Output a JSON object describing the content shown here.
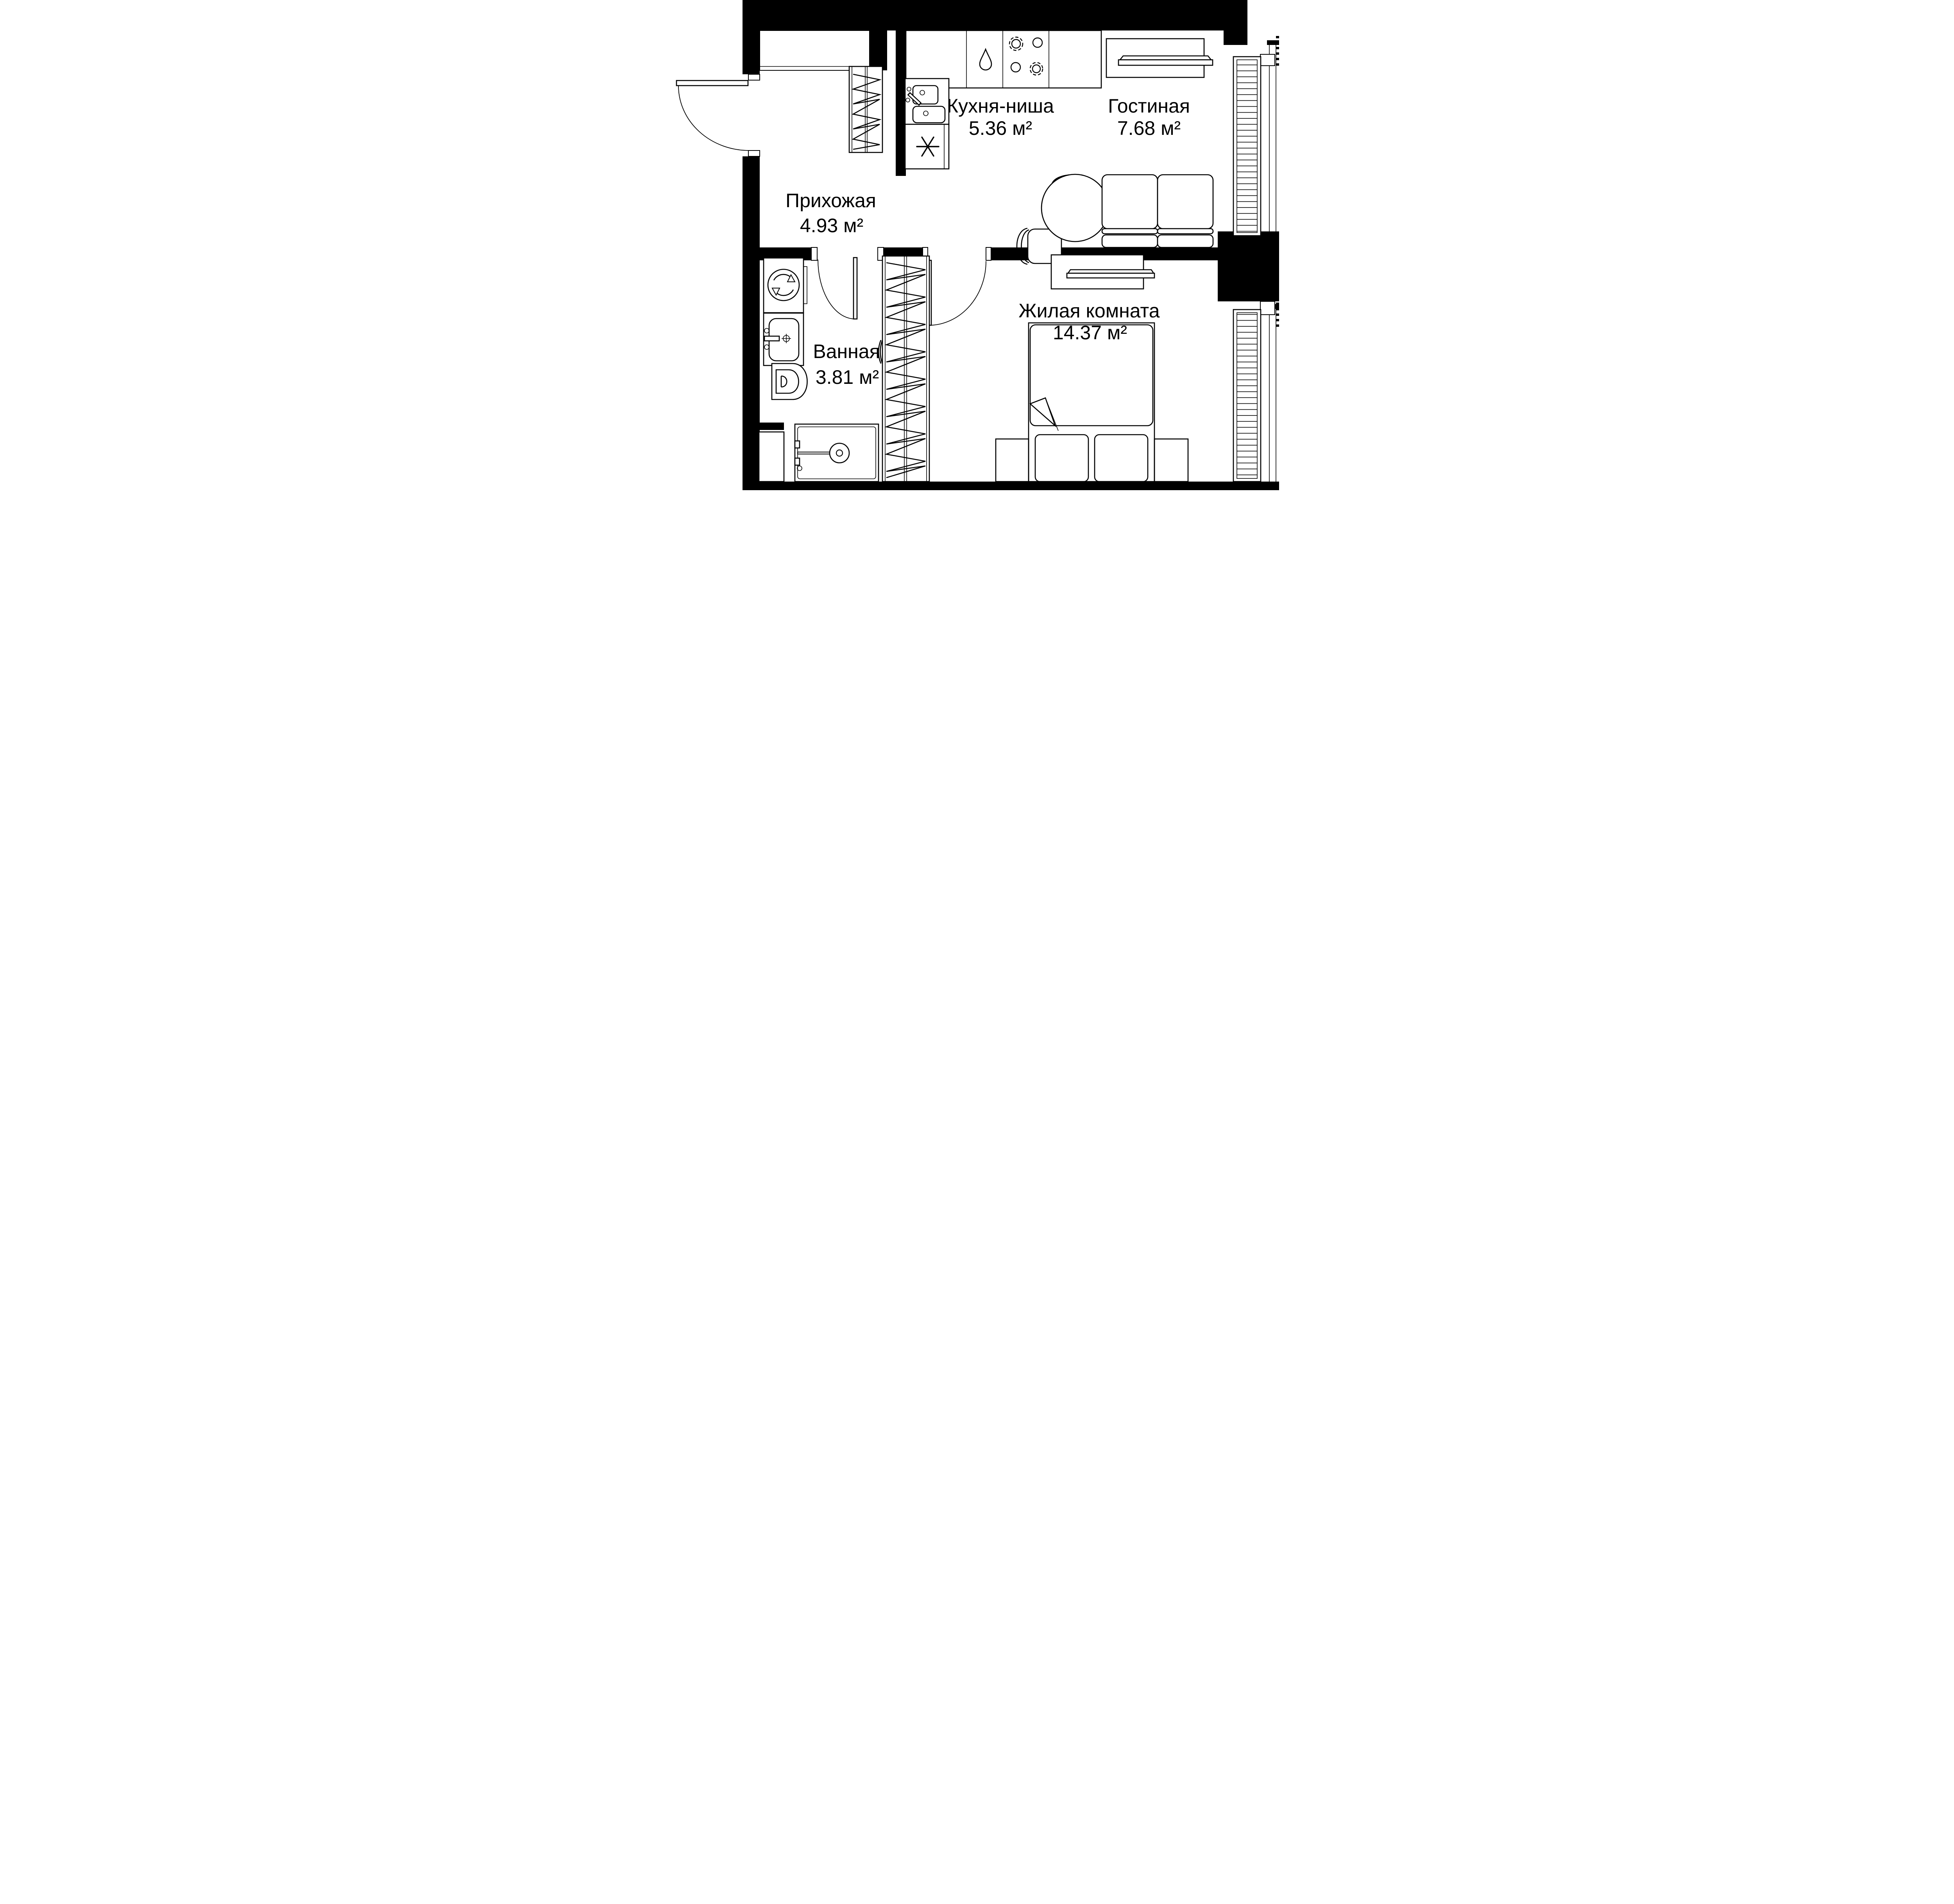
{
  "rooms": {
    "kitchen": {
      "name": "Кухня-ниша",
      "area": "5.36 м²"
    },
    "living": {
      "name": "Гостиная",
      "area": "7.68 м²"
    },
    "hallway": {
      "name": "Прихожая",
      "area": "4.93 м²"
    },
    "bathroom": {
      "name": "Ванная",
      "area": "3.81 м²"
    },
    "bedroom": {
      "name": "Жилая комната",
      "area": "14.37 м²"
    }
  },
  "fixtures": [
    "entrance-door",
    "hallway-wardrobe",
    "kitchen-counter",
    "dishwasher-drop",
    "stove-burners",
    "kitchen-sink",
    "fridge-asterisk",
    "tv-living",
    "dining-table",
    "chairs",
    "sofa",
    "radiator-living",
    "bedroom-door",
    "bathroom-door",
    "washing-machine",
    "bathroom-sink",
    "toilet",
    "shower",
    "duct-shaft",
    "tall-wardrobe",
    "tv-bedroom",
    "bed",
    "nightstands",
    "radiator-bedroom",
    "windows"
  ],
  "colors": {
    "wall": "#000000",
    "line": "#000000",
    "background": "#ffffff"
  }
}
